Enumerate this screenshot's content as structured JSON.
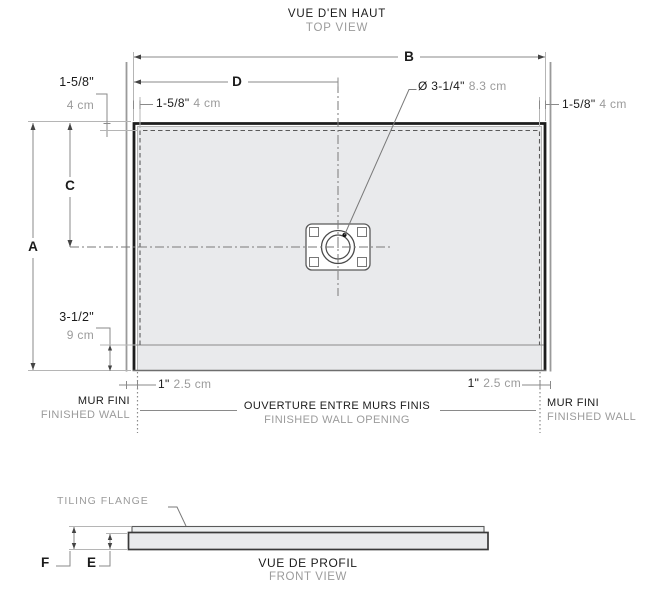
{
  "top_view": {
    "title_fr": "VUE D'EN HAUT",
    "title_en": "TOP VIEW",
    "dim_letters": {
      "A": "A",
      "B": "B",
      "C": "C",
      "D": "D"
    },
    "flange_left": {
      "imperial": "1-5/8\"",
      "metric": "4 cm"
    },
    "flange_top": {
      "imperial": "1-5/8\"",
      "metric": "4 cm"
    },
    "flange_right": {
      "imperial": "1-5/8\"",
      "metric": "4 cm"
    },
    "drain_diameter": {
      "imperial": "Ø 3-1/4\"",
      "metric": "8.3 cm"
    },
    "front_ledge": {
      "imperial": "3-1/2\"",
      "metric": "9 cm"
    },
    "overhang_left": {
      "imperial": "1\"",
      "metric": "2.5 cm"
    },
    "overhang_right": {
      "imperial": "1\"",
      "metric": "2.5 cm"
    },
    "wall_left": {
      "fr": "MUR FINI",
      "en": "FINISHED WALL"
    },
    "wall_right": {
      "fr": "MUR FINI",
      "en": "FINISHED WALL"
    },
    "opening": {
      "fr": "OUVERTURE ENTRE MURS FINIS",
      "en": "FINISHED WALL OPENING"
    }
  },
  "front_view": {
    "title_fr": "VUE DE PROFIL",
    "title_en": "FRONT VIEW",
    "flange_label": "TILING FLANGE",
    "dim_letters": {
      "E": "E",
      "F": "F"
    }
  },
  "colors": {
    "ink": "#1b1b1b",
    "muted": "#9b9b9b",
    "fill": "#e9eaec",
    "line": "#8a8a8a"
  }
}
